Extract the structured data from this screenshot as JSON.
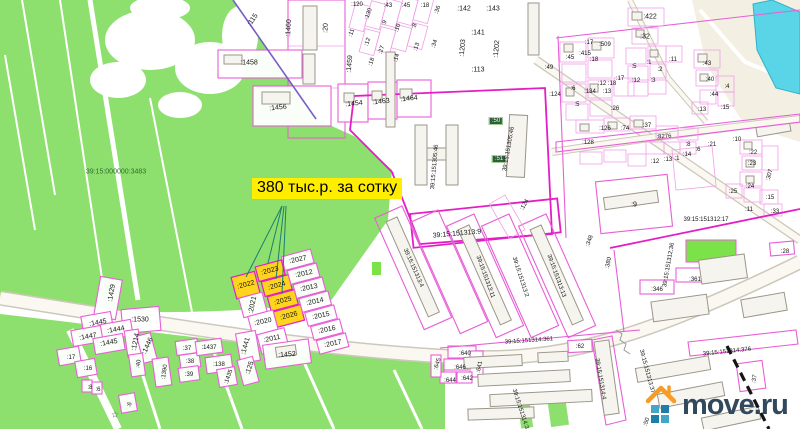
{
  "map": {
    "type": "cadastral-map",
    "price_label": {
      "text": "380 тыс.р. за сотку",
      "bg": "#ffee00",
      "fg": "#000000"
    },
    "watermark": {
      "text": "move.ru",
      "house_icon": "house-icon",
      "house_color": "#f59d27",
      "text_color": "#32485c",
      "square_colors": [
        "#45a5c5",
        "#1d7fa6",
        "#1d7fa6",
        "#45a5c5"
      ]
    },
    "highlighted_parcels": [
      ":2022",
      ":2023",
      ":2024",
      ":2025",
      ":2026"
    ],
    "colors": {
      "field_green": "#8ee06e",
      "bright_green": "#7ce24a",
      "parcel_pink": "#f0a0e6",
      "parcel_magenta": "#e31ec6",
      "highlight_yellow": "#ffd41c",
      "water_cyan": "#59d5e7",
      "road_cream": "#f3efe2",
      "callout_teal": "#1d7d72",
      "purple_boundary": "#7b5bc9",
      "railroad_black": "#151515"
    },
    "labels": [
      {
        "t": "39:15:000000:3483",
        "x": 116,
        "y": 172,
        "c": "#2e6b2e"
      },
      {
        "t": ":115",
        "x": 253,
        "y": 20,
        "r": -55
      },
      {
        "t": ":1460",
        "x": 289,
        "y": 28,
        "r": -87
      },
      {
        "t": ":20",
        "x": 326,
        "y": 28,
        "r": -87
      },
      {
        "t": ":120",
        "x": 357,
        "y": 5,
        "s": 6
      },
      {
        "t": ":130",
        "x": 369,
        "y": 14,
        "r": -70,
        "s": 6
      },
      {
        "t": ":43",
        "x": 388,
        "y": 6,
        "s": 6
      },
      {
        "t": ":45",
        "x": 406,
        "y": 6,
        "s": 6
      },
      {
        "t": ":18",
        "x": 425,
        "y": 6,
        "s": 6
      },
      {
        "t": ":36",
        "x": 438,
        "y": 10,
        "r": -70,
        "s": 6
      },
      {
        "t": ":11",
        "x": 352,
        "y": 33,
        "r": -70,
        "s": 6
      },
      {
        "t": ":9",
        "x": 385,
        "y": 23,
        "r": -70,
        "s": 6
      },
      {
        "t": ":10",
        "x": 398,
        "y": 28,
        "r": -70,
        "s": 6
      },
      {
        "t": ":12",
        "x": 368,
        "y": 42,
        "r": -70,
        "s": 6
      },
      {
        "t": ":8",
        "x": 415,
        "y": 26,
        "r": -70,
        "s": 6
      },
      {
        "t": ":27",
        "x": 382,
        "y": 50,
        "r": -70,
        "s": 6
      },
      {
        "t": ":18",
        "x": 372,
        "y": 62,
        "r": -70,
        "s": 6
      },
      {
        "t": ":14",
        "x": 397,
        "y": 58,
        "r": -70,
        "s": 6
      },
      {
        "t": ":13",
        "x": 417,
        "y": 47,
        "r": -70,
        "s": 6
      },
      {
        "t": ":34",
        "x": 435,
        "y": 44,
        "r": -70,
        "s": 6
      },
      {
        "t": ":1459",
        "x": 350,
        "y": 64,
        "r": -85
      },
      {
        "t": ":1458",
        "x": 249,
        "y": 63
      },
      {
        "t": ":1456",
        "x": 278,
        "y": 108,
        "r": -6
      },
      {
        "t": ":1454",
        "x": 354,
        "y": 104,
        "r": -6
      },
      {
        "t": ":1463",
        "x": 381,
        "y": 102,
        "r": -6
      },
      {
        "t": ":1464",
        "x": 409,
        "y": 99,
        "r": -6
      },
      {
        "t": ":142",
        "x": 464,
        "y": 9
      },
      {
        "t": ":143",
        "x": 493,
        "y": 9
      },
      {
        "t": ":141",
        "x": 478,
        "y": 33
      },
      {
        "t": ":1203",
        "x": 463,
        "y": 48,
        "r": -85
      },
      {
        "t": ":1202",
        "x": 497,
        "y": 49,
        "r": -85
      },
      {
        "t": ":113",
        "x": 478,
        "y": 70
      },
      {
        "t": ":49",
        "x": 549,
        "y": 68,
        "s": 6
      },
      {
        "t": ":45",
        "x": 570,
        "y": 58,
        "s": 6
      },
      {
        "t": ":17",
        "x": 589,
        "y": 43,
        "s": 6
      },
      {
        "t": ":415",
        "x": 585,
        "y": 54,
        "s": 6
      },
      {
        "t": ":18",
        "x": 594,
        "y": 60,
        "s": 6
      },
      {
        "t": ":509",
        "x": 605,
        "y": 45,
        "s": 6
      },
      {
        "t": ":124",
        "x": 555,
        "y": 95,
        "s": 6
      },
      {
        "t": ":134",
        "x": 590,
        "y": 92,
        "s": 6
      },
      {
        "t": ":12",
        "x": 602,
        "y": 84,
        "s": 6
      },
      {
        "t": ":13",
        "x": 607,
        "y": 92,
        "s": 6
      },
      {
        "t": ":18",
        "x": 612,
        "y": 84,
        "s": 6
      },
      {
        "t": ":17",
        "x": 620,
        "y": 79,
        "s": 6
      },
      {
        "t": ":26",
        "x": 615,
        "y": 109,
        "s": 6
      },
      {
        "t": ":6",
        "x": 573,
        "y": 89,
        "s": 6
      },
      {
        "t": ":5",
        "x": 577,
        "y": 105,
        "s": 6
      },
      {
        "t": ":422",
        "x": 650,
        "y": 17
      },
      {
        "t": ":32",
        "x": 645,
        "y": 37
      },
      {
        "t": ":5",
        "x": 634,
        "y": 67,
        "s": 6
      },
      {
        "t": ":1",
        "x": 649,
        "y": 63,
        "s": 6
      },
      {
        "t": ":11",
        "x": 673,
        "y": 60,
        "s": 6
      },
      {
        "t": ":2",
        "x": 660,
        "y": 70,
        "s": 6
      },
      {
        "t": ":12",
        "x": 636,
        "y": 81,
        "s": 6
      },
      {
        "t": ":3",
        "x": 653,
        "y": 81,
        "s": 6
      },
      {
        "t": ":43",
        "x": 707,
        "y": 64,
        "s": 6
      },
      {
        "t": ":40",
        "x": 710,
        "y": 80,
        "s": 6
      },
      {
        "t": ":4",
        "x": 727,
        "y": 87,
        "s": 6
      },
      {
        "t": ":44",
        "x": 714,
        "y": 95,
        "s": 6
      },
      {
        "t": ":15",
        "x": 725,
        "y": 108,
        "s": 6
      },
      {
        "t": ":13",
        "x": 702,
        "y": 110,
        "s": 6
      },
      {
        "t": ":126",
        "x": 605,
        "y": 129,
        "s": 6
      },
      {
        "t": ":128",
        "x": 588,
        "y": 143,
        "s": 6
      },
      {
        "t": ":74",
        "x": 625,
        "y": 129,
        "s": 6
      },
      {
        "t": ":37",
        "x": 647,
        "y": 126,
        "s": 6
      },
      {
        "t": ":8276",
        "x": 664,
        "y": 137,
        "r": -4,
        "s": 6
      },
      {
        "t": ":8",
        "x": 688,
        "y": 145,
        "s": 6
      },
      {
        "t": ":6",
        "x": 698,
        "y": 150,
        "s": 6
      },
      {
        "t": ":21",
        "x": 712,
        "y": 145,
        "s": 6
      },
      {
        "t": ":10",
        "x": 737,
        "y": 140,
        "s": 6
      },
      {
        "t": ":14",
        "x": 687,
        "y": 155,
        "s": 6
      },
      {
        "t": ":12",
        "x": 655,
        "y": 162,
        "s": 6
      },
      {
        "t": ":13",
        "x": 668,
        "y": 160,
        "s": 6
      },
      {
        "t": ":1",
        "x": 677,
        "y": 159,
        "s": 6
      },
      {
        "t": ":22",
        "x": 753,
        "y": 153,
        "s": 6
      },
      {
        "t": ":23",
        "x": 752,
        "y": 164,
        "s": 6
      },
      {
        "t": ":307",
        "x": 770,
        "y": 175,
        "r": -75,
        "s": 6
      },
      {
        "t": ":24",
        "x": 750,
        "y": 187,
        "s": 6
      },
      {
        "t": ":25",
        "x": 733,
        "y": 192,
        "s": 6
      },
      {
        "t": ":15",
        "x": 770,
        "y": 198,
        "s": 6
      },
      {
        "t": ":11",
        "x": 749,
        "y": 210,
        "s": 6
      },
      {
        "t": ":33",
        "x": 775,
        "y": 212,
        "s": 6
      },
      {
        "t": ":9",
        "x": 634,
        "y": 205
      },
      {
        "t": "39:15:151312:17",
        "x": 706,
        "y": 220,
        "s": 6
      },
      {
        "t": ":380",
        "x": 609,
        "y": 263,
        "r": -78,
        "s": 6
      },
      {
        "t": "39:15:151312:36",
        "x": 669,
        "y": 265,
        "r": -80,
        "s": 6
      },
      {
        "t": ":346",
        "x": 657,
        "y": 290,
        "s": 6
      },
      {
        "t": ":361",
        "x": 695,
        "y": 280,
        "s": 6
      },
      {
        "t": ":28",
        "x": 785,
        "y": 252,
        "s": 6
      },
      {
        "t": ":348",
        "x": 590,
        "y": 241,
        "r": -70,
        "s": 6
      },
      {
        "t": ":50",
        "x": 496,
        "y": 121,
        "b": true,
        "s": 6
      },
      {
        "t": ":51",
        "x": 499,
        "y": 159,
        "b": true,
        "s": 6
      },
      {
        "t": "39:15:151305:46",
        "x": 509,
        "y": 149,
        "r": -80,
        "s": 6
      },
      {
        "t": "39:15:151305:46",
        "x": 435,
        "y": 167,
        "r": -85,
        "s": 6
      },
      {
        "t": "39:15:151313:9",
        "x": 457,
        "y": 234,
        "r": -5
      },
      {
        "t": ":124",
        "x": 525,
        "y": 205,
        "r": -60,
        "s": 6
      },
      {
        "t": "39:15:151313:4",
        "x": 413,
        "y": 268,
        "r": 66,
        "s": 6
      },
      {
        "t": "39:15:151313:11",
        "x": 485,
        "y": 277,
        "r": 70,
        "s": 6
      },
      {
        "t": "39:15:151313:2",
        "x": 520,
        "y": 277,
        "r": 72,
        "s": 6
      },
      {
        "t": "39:15:151313:13",
        "x": 556,
        "y": 276,
        "r": 70,
        "s": 6
      },
      {
        "t": "39:15:151314:361",
        "x": 529,
        "y": 341,
        "r": -4,
        "s": 6
      },
      {
        "t": ":640",
        "x": 465,
        "y": 354,
        "s": 6
      },
      {
        "t": ":646",
        "x": 460,
        "y": 368,
        "s": 6
      },
      {
        "t": ":641",
        "x": 480,
        "y": 367,
        "r": -78,
        "s": 6
      },
      {
        "t": ":644",
        "x": 450,
        "y": 381,
        "s": 6
      },
      {
        "t": ":642",
        "x": 467,
        "y": 379,
        "s": 6
      },
      {
        "t": ":645",
        "x": 438,
        "y": 364,
        "r": -72,
        "s": 6
      },
      {
        "t": ":62",
        "x": 580,
        "y": 347,
        "s": 6
      },
      {
        "t": "39:15:151314:4",
        "x": 600,
        "y": 379,
        "r": 80,
        "s": 6
      },
      {
        "t": "39:15:151314:3",
        "x": 520,
        "y": 409,
        "r": 72,
        "s": 6
      },
      {
        "t": "39:15:151314:376",
        "x": 727,
        "y": 352,
        "r": -6,
        "s": 6
      },
      {
        "t": ":37",
        "x": 755,
        "y": 379,
        "r": -78,
        "s": 6
      },
      {
        "t": "39:15:151313:377",
        "x": 647,
        "y": 373,
        "r": 75,
        "s": 6
      },
      {
        "t": ":50",
        "x": 647,
        "y": 422,
        "r": -70,
        "s": 6
      },
      {
        "t": ":1429",
        "x": 112,
        "y": 293,
        "r": -80
      },
      {
        "t": ":1530",
        "x": 140,
        "y": 320
      },
      {
        "t": ":1445",
        "x": 98,
        "y": 323,
        "r": -10
      },
      {
        "t": ":1444",
        "x": 116,
        "y": 330,
        "r": -10
      },
      {
        "t": ":1447",
        "x": 88,
        "y": 337,
        "r": -10
      },
      {
        "t": ":1445",
        "x": 109,
        "y": 343,
        "r": -10
      },
      {
        "t": ":1214",
        "x": 136,
        "y": 342,
        "r": -78
      },
      {
        "t": ":1446",
        "x": 148,
        "y": 346,
        "r": -65
      },
      {
        "t": ":17",
        "x": 71,
        "y": 358,
        "s": 6
      },
      {
        "t": ":16",
        "x": 88,
        "y": 369,
        "s": 6
      },
      {
        "t": ":40",
        "x": 139,
        "y": 364,
        "r": -78,
        "s": 6
      },
      {
        "t": ":1390",
        "x": 165,
        "y": 372,
        "r": -82,
        "s": 6
      },
      {
        "t": ":37",
        "x": 187,
        "y": 349,
        "s": 6
      },
      {
        "t": ":38",
        "x": 190,
        "y": 362,
        "s": 6
      },
      {
        "t": ":39",
        "x": 189,
        "y": 375,
        "s": 6
      },
      {
        "t": ":1437",
        "x": 209,
        "y": 348,
        "s": 6
      },
      {
        "t": ":138",
        "x": 219,
        "y": 365,
        "s": 6
      },
      {
        "t": ":1435",
        "x": 229,
        "y": 377,
        "r": -70,
        "s": 6
      },
      {
        "t": ":8",
        "x": 90,
        "y": 388,
        "s": 6
      },
      {
        "t": ":6",
        "x": 98,
        "y": 390,
        "s": 6
      },
      {
        "t": ":6",
        "x": 130,
        "y": 405,
        "r": -65,
        "s": 6
      },
      {
        "t": "☆",
        "x": 115,
        "y": 415,
        "s": 9,
        "c": "#4a4a4a"
      },
      {
        "t": ":125",
        "x": 250,
        "y": 368,
        "r": -70
      },
      {
        "t": ":2022",
        "x": 246,
        "y": 285,
        "r": -15
      },
      {
        "t": ":2023",
        "x": 270,
        "y": 271,
        "r": -15
      },
      {
        "t": ":2024",
        "x": 277,
        "y": 286,
        "r": -15
      },
      {
        "t": ":2025",
        "x": 283,
        "y": 301,
        "r": -15
      },
      {
        "t": ":2026",
        "x": 289,
        "y": 316,
        "r": -15
      },
      {
        "t": ":2027",
        "x": 298,
        "y": 260,
        "r": -12
      },
      {
        "t": ":2012",
        "x": 304,
        "y": 274,
        "r": -12
      },
      {
        "t": ":2013",
        "x": 309,
        "y": 288,
        "r": -12
      },
      {
        "t": ":2014",
        "x": 315,
        "y": 302,
        "r": -12
      },
      {
        "t": ":2015",
        "x": 321,
        "y": 316,
        "r": -12
      },
      {
        "t": ":2016",
        "x": 327,
        "y": 330,
        "r": -12
      },
      {
        "t": ":2017",
        "x": 333,
        "y": 344,
        "r": -12
      },
      {
        "t": ":2021",
        "x": 253,
        "y": 305,
        "r": -78
      },
      {
        "t": ":2020",
        "x": 263,
        "y": 322,
        "r": -12
      },
      {
        "t": ":2011",
        "x": 272,
        "y": 339,
        "r": -12
      },
      {
        "t": ":1441",
        "x": 246,
        "y": 346,
        "r": -75
      },
      {
        "t": ":1452",
        "x": 287,
        "y": 355,
        "r": -4
      }
    ]
  }
}
